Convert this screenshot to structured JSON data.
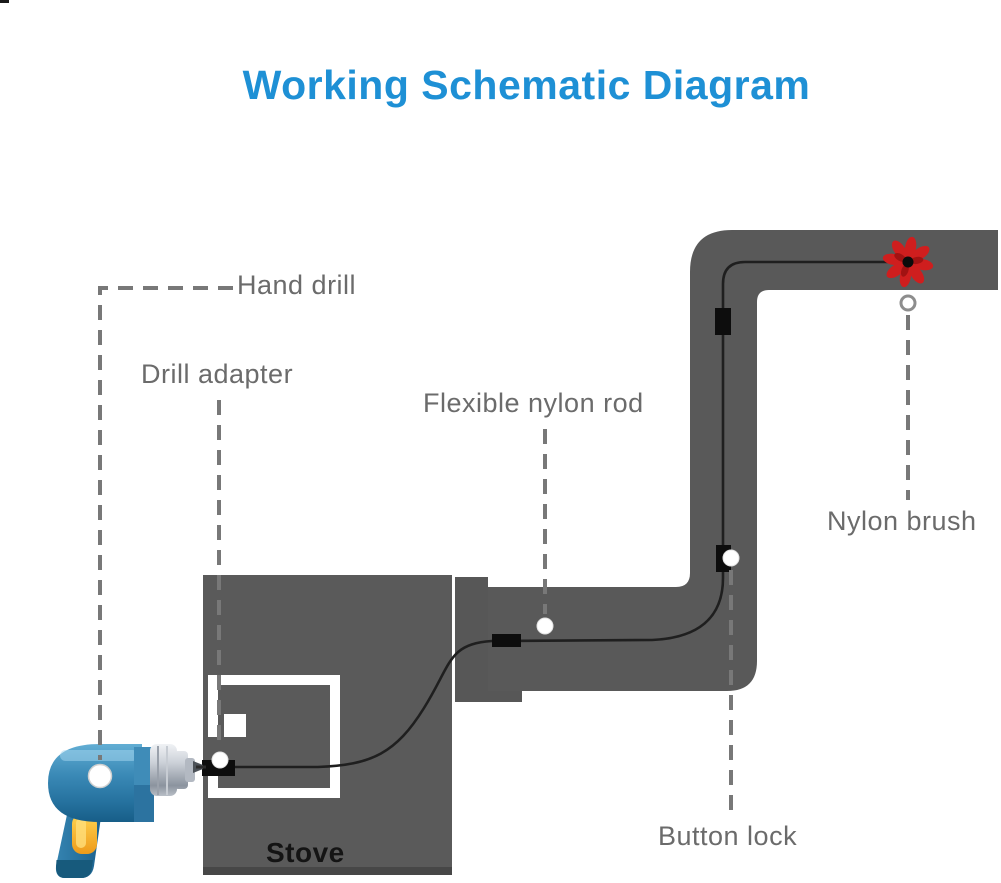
{
  "title": {
    "text": "Working Schematic Diagram"
  },
  "labels": {
    "hand_drill": "Hand drill",
    "drill_adapter": "Drill adapter",
    "flexible_nylon_rod": "Flexible nylon rod",
    "nylon_brush": "Nylon brush",
    "button_lock": "Button lock",
    "stove": "Stove"
  },
  "colors": {
    "title_blue": "#1e90d5",
    "label_gray": "#6b6b6b",
    "pipe_gray": "#595959",
    "stove_gray": "#5a5a5a",
    "flange_gray": "#575757",
    "rod_black": "#1f1f1f",
    "lock_black": "#0d0d0d",
    "brush_red": "#cf1e1e",
    "leader_gray": "#787878",
    "drill_body_blue": "#3a89b6",
    "drill_trigger_yellow": "#f0a422",
    "door_white": "#ffffff"
  },
  "icons": {
    "drill": "hand-drill-icon",
    "brush": "nylon-brush-icon",
    "adapter": "drill-adapter-icon",
    "locks": "button-lock-icon",
    "marker_dots": "leader-dot-icon"
  }
}
